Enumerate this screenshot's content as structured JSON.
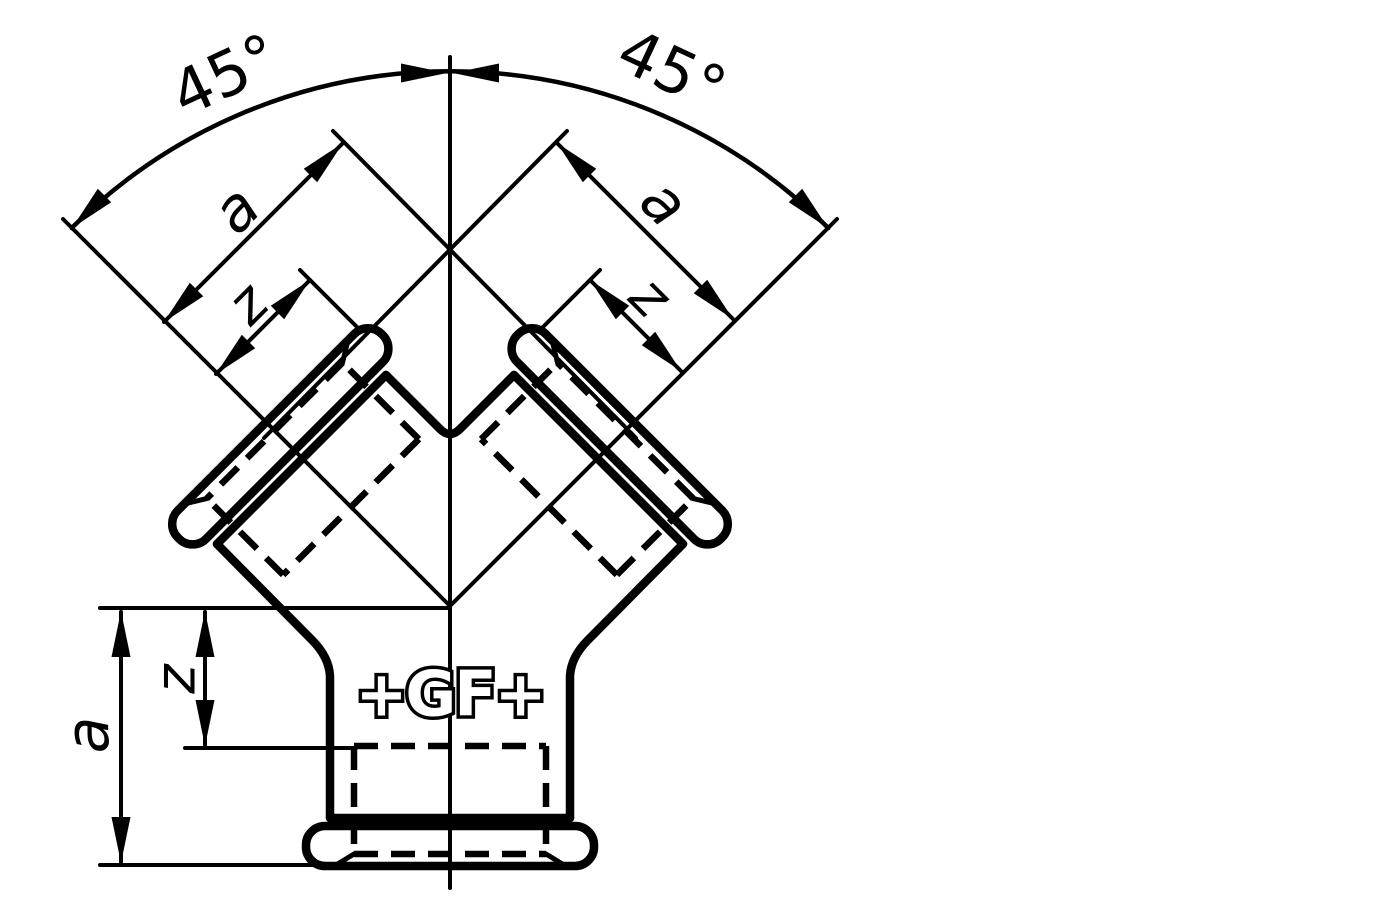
{
  "figure": {
    "background": "#ffffff",
    "line_color": "#000000",
    "labels": {
      "angle_left": "45°",
      "angle_right": "45°",
      "left_branch": {
        "a": "a",
        "z": "z"
      },
      "right_branch": {
        "a": "a",
        "z": "z"
      },
      "bottom_socket": {
        "a": "a",
        "z": "z"
      },
      "logo": "+GF+"
    }
  }
}
